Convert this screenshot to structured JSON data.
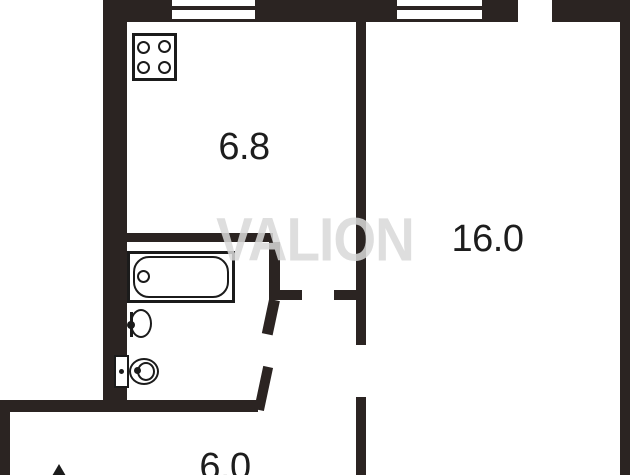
{
  "watermark": {
    "text": "VALION"
  },
  "rooms": {
    "kitchen": {
      "area": "6.8"
    },
    "living_room": {
      "area": "16.0"
    },
    "hallway": {
      "area": "6.0"
    }
  },
  "fixtures": {
    "stove": "stove-icon",
    "bathtub": "bathtub-icon",
    "sink": "sink-icon",
    "toilet": "toilet-icon",
    "entrance_arrow": "entrance-arrow-icon"
  },
  "colors": {
    "wall": "#2b2422",
    "line": "#1b1b1b",
    "background": "#ffffff",
    "watermark": "#d9d9d9",
    "label": "#1d1d1d"
  }
}
